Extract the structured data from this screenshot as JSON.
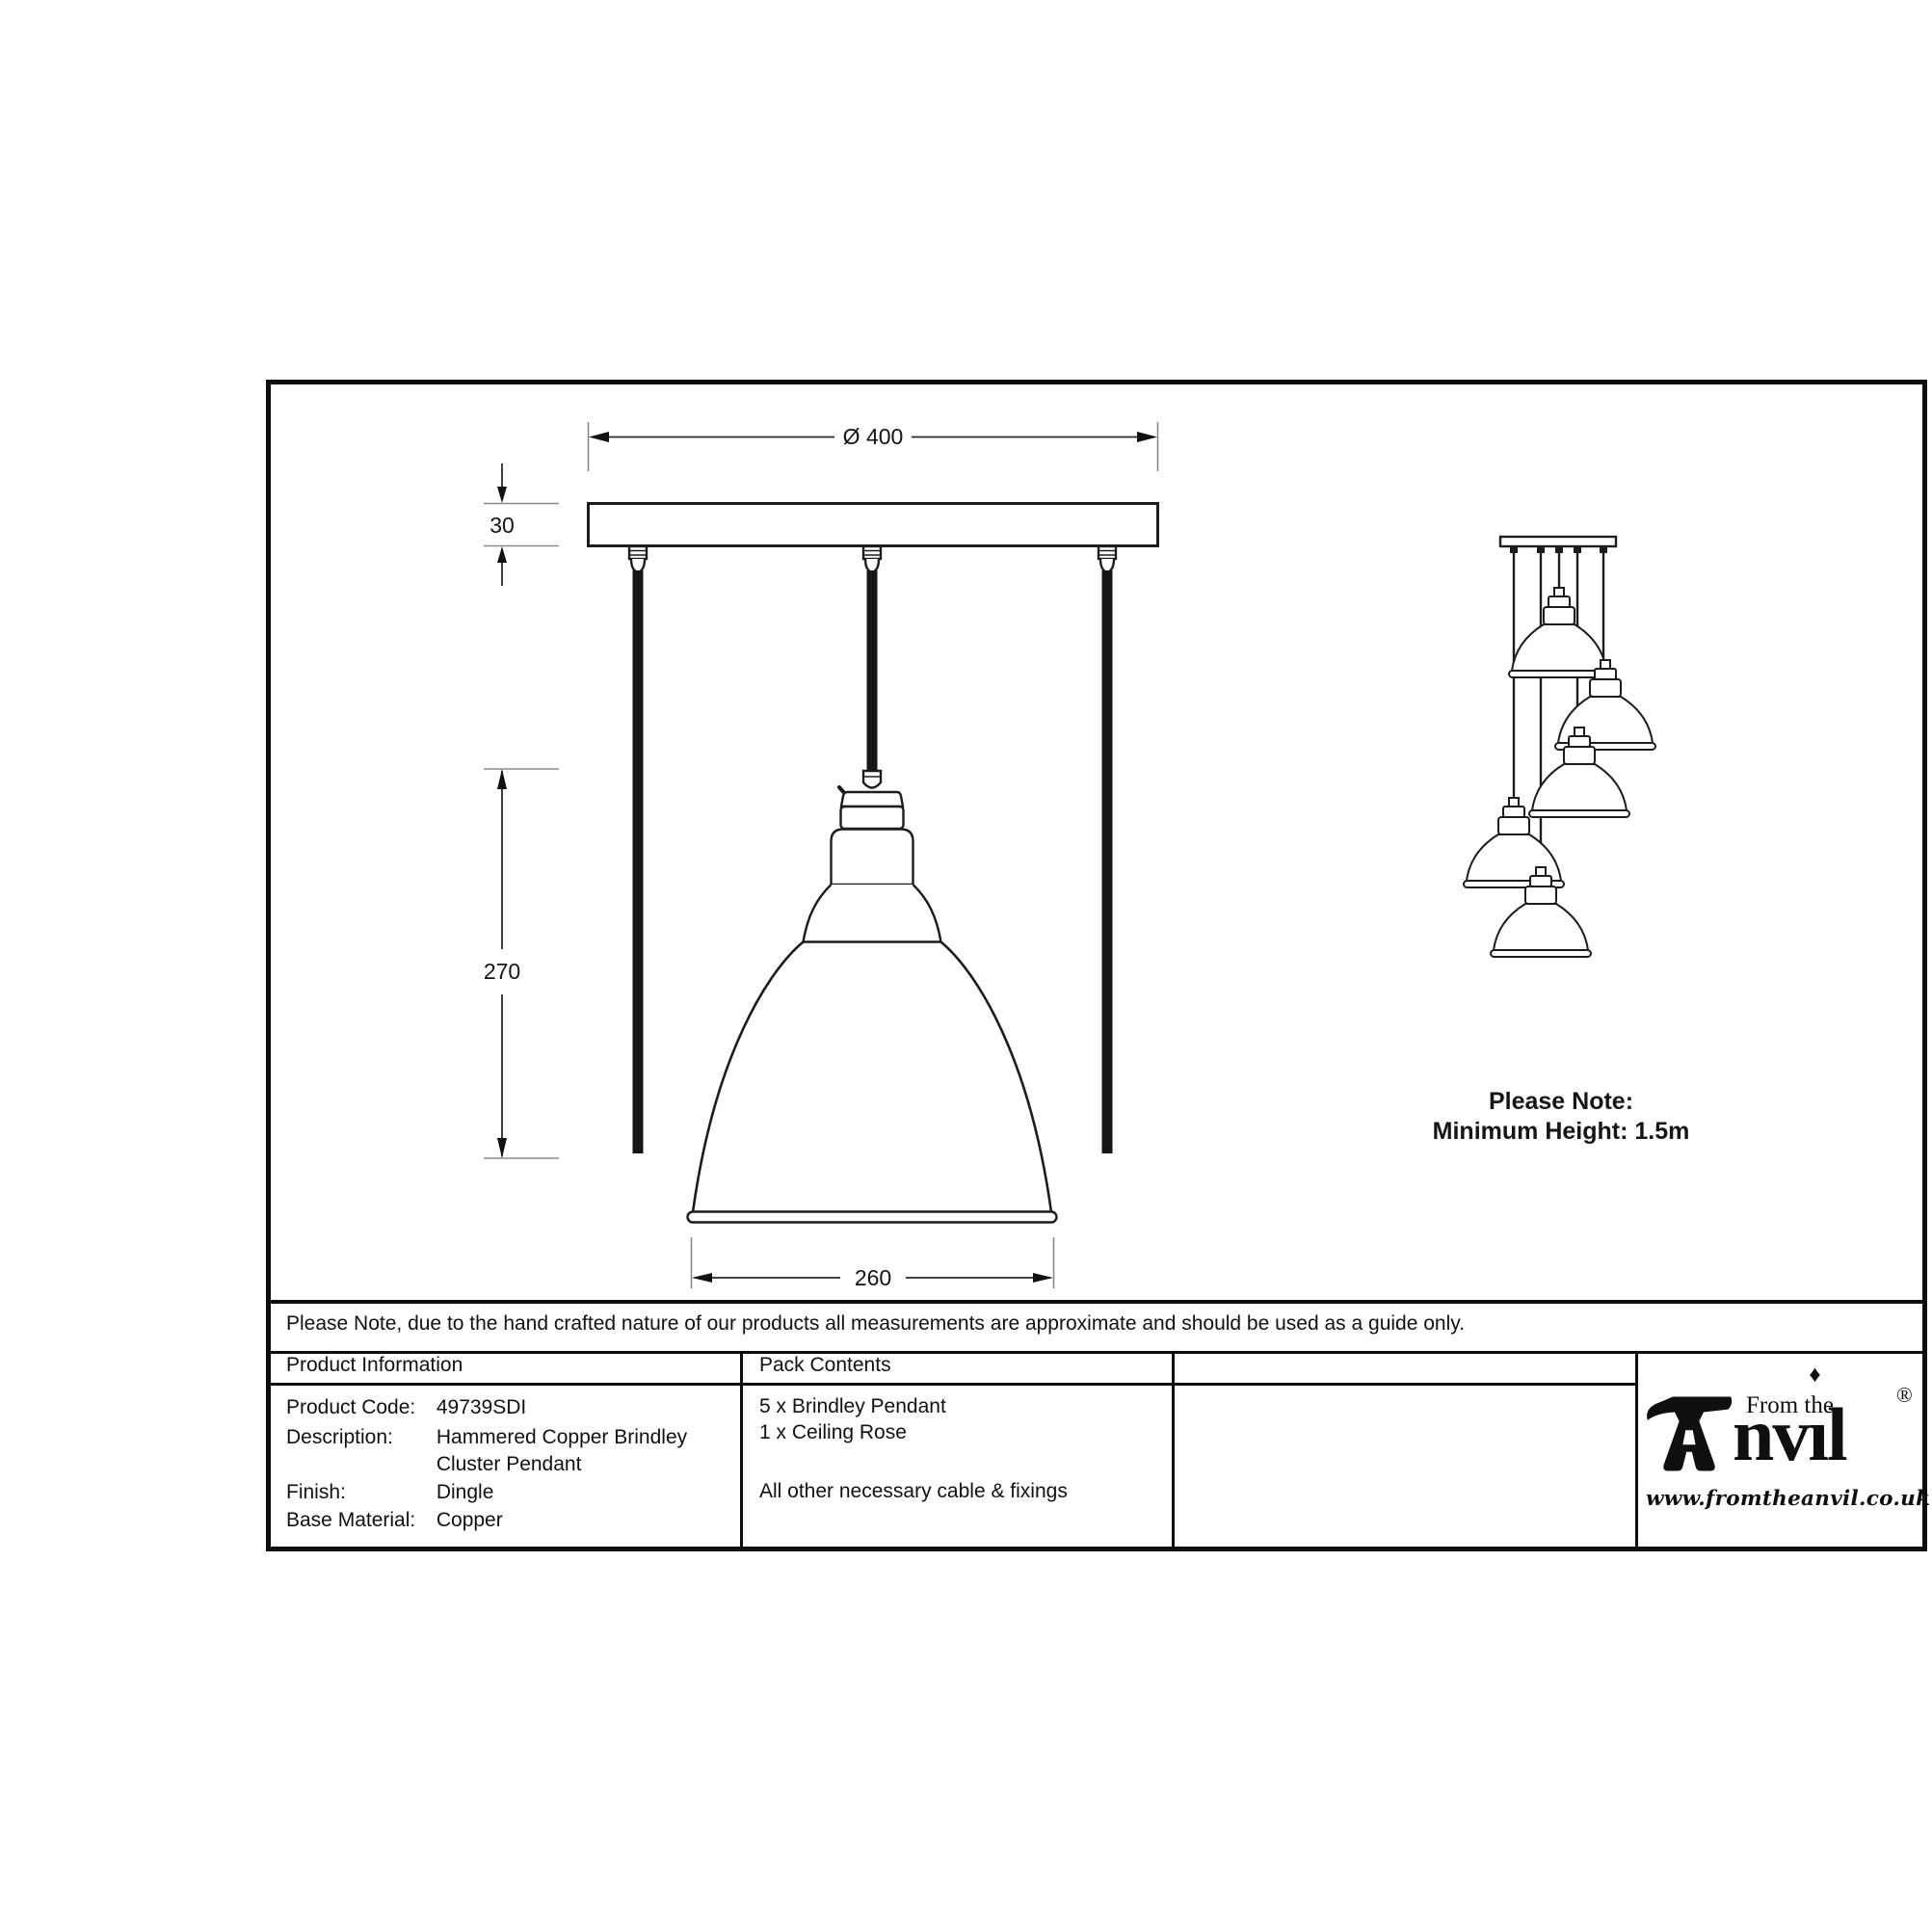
{
  "sheet": {
    "note": "Please Note, due to the hand crafted nature of our products all measurements are approximate and should be used as a guide only."
  },
  "dimensions": {
    "diameter": "Ø 400",
    "plate_height": "30",
    "pendant_height": "270",
    "shade_diameter": "260"
  },
  "cluster_note": {
    "line1": "Please Note:",
    "line2": "Minimum Height: 1.5m"
  },
  "product_information": {
    "header": "Product Information",
    "rows": [
      {
        "label": "Product Code:",
        "value": "49739SDI"
      },
      {
        "label": "Description:",
        "value": "Hammered Copper Brindley"
      },
      {
        "label": "",
        "value": "Cluster Pendant"
      },
      {
        "label": "Finish:",
        "value": "Dingle"
      },
      {
        "label": "Base Material:",
        "value": "Copper"
      }
    ]
  },
  "pack_contents": {
    "header": "Pack Contents",
    "items": [
      "5 x Brindley Pendant",
      "1 x Ceiling Rose",
      "All other necessary cable & fixings"
    ]
  },
  "logo": {
    "brand_full": "Anvil",
    "prefix": "From the",
    "brand_nv": "nv",
    "brand_il": "ıl",
    "diamond": "♦",
    "registered": "®",
    "website": "www.fromtheanvil.co.uk"
  }
}
